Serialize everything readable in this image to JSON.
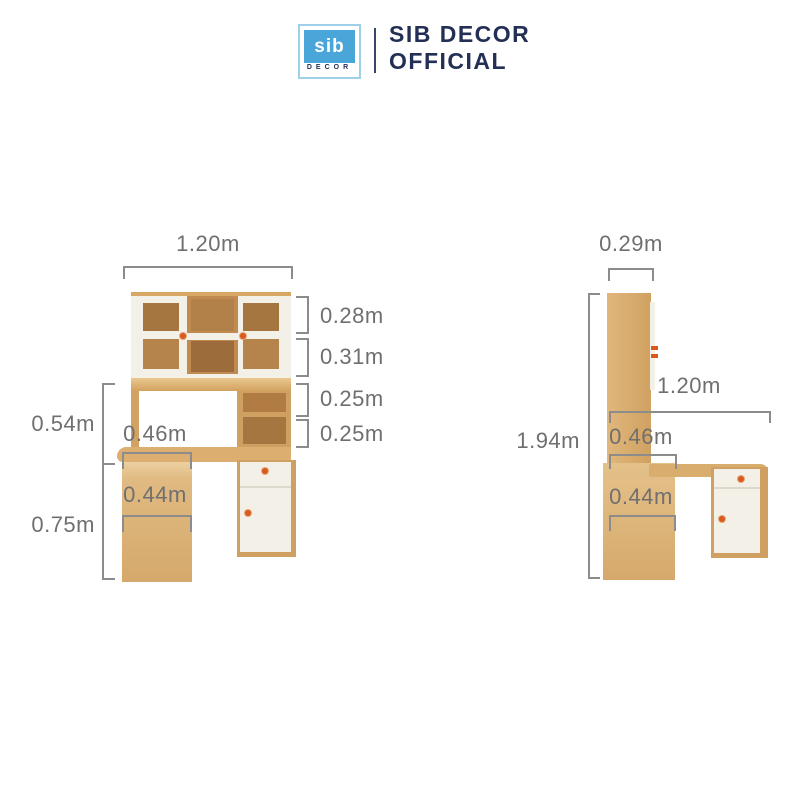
{
  "header": {
    "logo_text": "sib",
    "logo_subtext": "DECOR",
    "title_line1": "SIB DECOR",
    "title_line2": "OFFICIAL"
  },
  "front_view": {
    "top_width": "1.20m",
    "shelf_heights": [
      "0.28m",
      "0.31m",
      "0.25m",
      "0.25m"
    ],
    "hutch_to_desk_height": "0.54m",
    "desk_height": "0.75m",
    "desk_depth": "0.46m",
    "pedestal_width": "0.44m"
  },
  "side_view": {
    "top_depth": "0.29m",
    "total_height": "1.94m",
    "desk_length": "1.20m",
    "desk_depth": "0.46m",
    "pedestal_depth": "0.44m"
  },
  "colors": {
    "background": "#ffffff",
    "brand-blue": "#4aa5d8",
    "brand-blue-border": "#9fd0ea",
    "brand-navy": "#232f55",
    "dim-line": "#8c8c8c",
    "dim-text": "#6f6f6f",
    "wood": "#d7a766",
    "wood-light": "#e9c88f",
    "wood-mid": "#b5834c",
    "wood-dark": "#a5763f",
    "wood-deep": "#9c6c3b",
    "panel-white": "#f3f0e8",
    "knob-orange": "#d95a1f"
  }
}
